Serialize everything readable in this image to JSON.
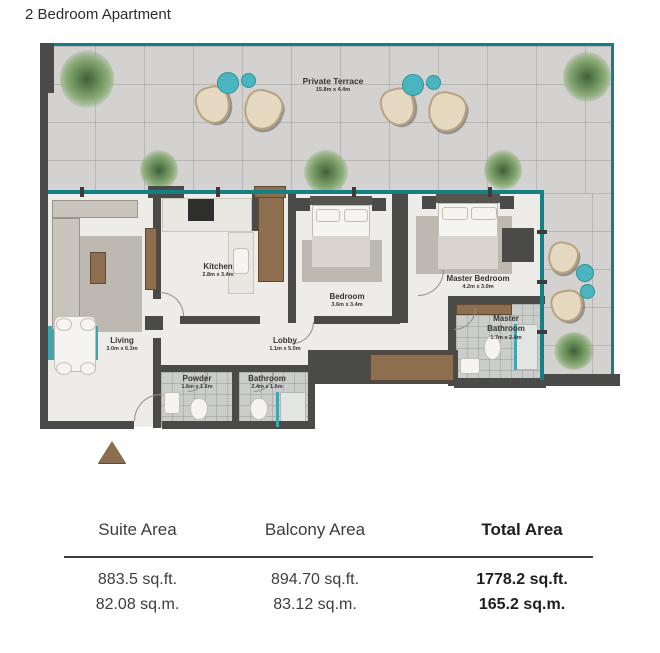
{
  "title": "2 Bedroom Apartment",
  "plan": {
    "terrace": {
      "label": "Private Terrace",
      "dims": "15.8m x 4.4m"
    },
    "rooms": {
      "living": {
        "label": "Living",
        "dims": "3.0m x 6.3m"
      },
      "kitchen": {
        "label": "Kitchen",
        "dims": "2.8m x 3.4m"
      },
      "lobby": {
        "label": "Lobby",
        "dims": "1.1m x 5.0m"
      },
      "powder": {
        "label": "Powder",
        "dims": "1.6m x 1.6m"
      },
      "bathroom": {
        "label": "Bathroom",
        "dims": "2.4m x 1.6m"
      },
      "bedroom": {
        "label": "Bedroom",
        "dims": "3.6m x 3.4m"
      },
      "master_bedroom": {
        "label": "Master Bedroom",
        "dims": "4.2m x 3.0m"
      },
      "master_bathroom": {
        "label": "Master Bathroom",
        "dims": "1.7m x 2.4m"
      }
    }
  },
  "colors": {
    "accent_teal": "#157f86",
    "teal_light": "#4ab5bf",
    "wall": "#4a4a48",
    "wood": "#8d6e4f",
    "terrace_floor": "#d3d2d0",
    "interior_floor": "#edece8"
  },
  "area_table": {
    "columns": [
      {
        "header": "Suite Area",
        "sqft": "883.5 sq.ft.",
        "sqm": "82.08 sq.m."
      },
      {
        "header": "Balcony Area",
        "sqft": "894.70 sq.ft.",
        "sqm": "83.12 sq.m."
      },
      {
        "header": "Total Area",
        "sqft": "1778.2 sq.ft.",
        "sqm": "165.2 sq.m."
      }
    ]
  }
}
